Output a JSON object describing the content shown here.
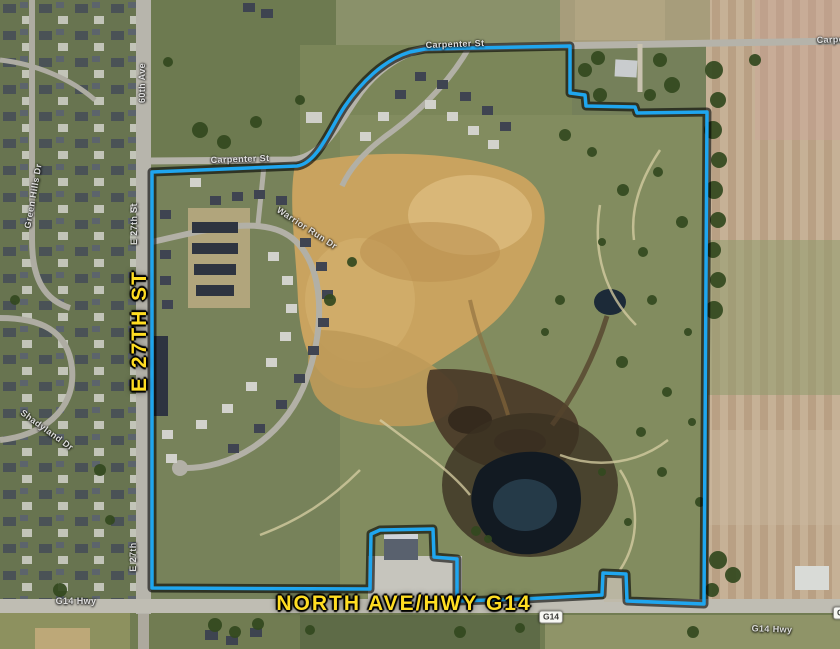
{
  "map": {
    "description": "Aerial property-boundary map",
    "colors": {
      "boundary_line": "#1fa6ef",
      "boundary_halo": "#000000",
      "primary_label_yellow": "#ffdd22",
      "street_label_white": "#f5f5f5"
    },
    "primary_labels": {
      "e27": {
        "text": "E 27TH ST",
        "orientation": "vertical"
      },
      "north_ave": {
        "text": "NORTH AVE/HWY G14",
        "orientation": "horizontal"
      }
    },
    "street_labels": {
      "carpenter_top": "Carpenter St",
      "carpenter_inner": "Carpenter St",
      "carpenter_right": "Carpenter St",
      "sixtieth_ave": "60th Ave",
      "e27th_mid": "E 27th St",
      "e27th_bottom": "E 27th",
      "green_hills": "Green Hills Dr",
      "shadyland": "Shadyland Dr",
      "warrior_run": "Warrior Run Dr",
      "g14_hwy_left": "G14 Hwy",
      "g14_hwy_right": "G14 Hwy"
    },
    "route_shields": {
      "g14": "G14",
      "g14_right_clipped": "G14"
    }
  }
}
